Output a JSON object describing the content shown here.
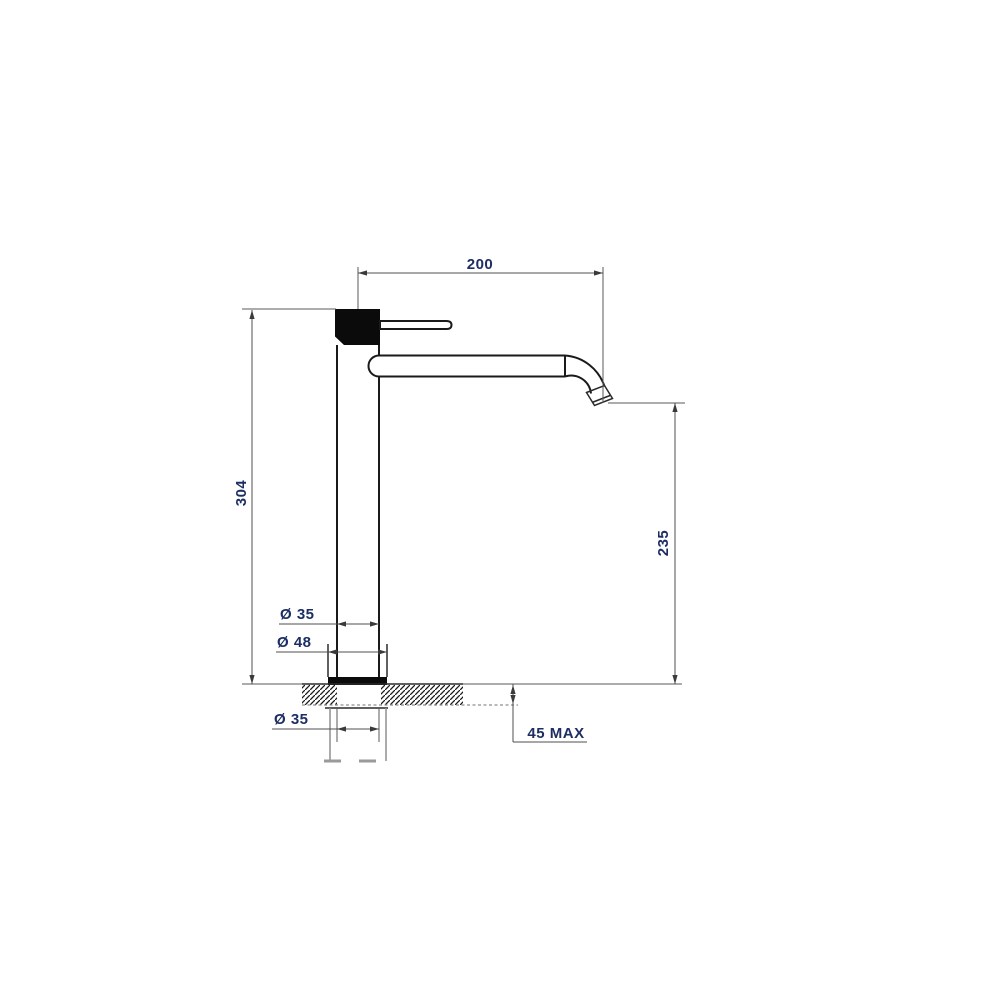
{
  "document": {
    "kind": "technical-drawing",
    "background": "#ffffff"
  },
  "colors": {
    "outline": "#1a1a1a",
    "dimension_line": "#4f4f4f",
    "label_text": "#1c2e63",
    "fill_solid": "#0b0b0b",
    "hatch": "#1a1a1a"
  },
  "dimensions": {
    "spout_reach": {
      "label": "200"
    },
    "overall_height": {
      "label": "304"
    },
    "spout_outlet_height": {
      "label": "235"
    },
    "body_diameter": {
      "label": "Ø 35"
    },
    "base_diameter": {
      "label": "Ø 48"
    },
    "shank_diameter": {
      "label": "Ø 35"
    },
    "max_deck_thickness": {
      "label": "45 MAX"
    }
  }
}
